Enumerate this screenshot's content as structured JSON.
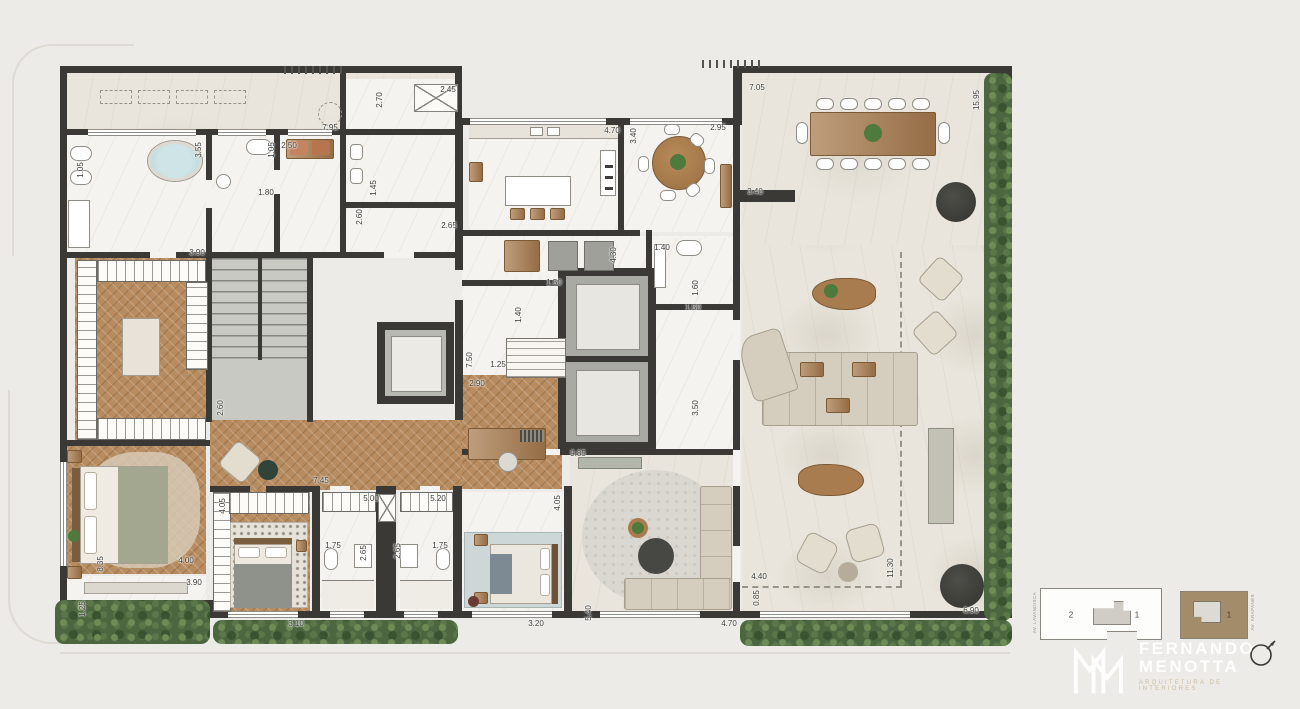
{
  "palette": {
    "bg": "#edebe7",
    "wall": "#3a3936",
    "marble_white": "#f5f3ef",
    "marble_warm": "#e9e5dc",
    "wood": "#b78c60",
    "wood_dark": "#a97c4f",
    "concrete": "#c8c9c3",
    "sofa": "#d5cebe",
    "hedge_green": "#4c6740",
    "keyplan_tan": "#a38c6a"
  },
  "annotations": {
    "dimensions": [
      {
        "t": "1.05",
        "x": 81,
        "y": 170,
        "v": true
      },
      {
        "t": "7.95",
        "x": 330,
        "y": 128,
        "v": false
      },
      {
        "t": "2.70",
        "x": 380,
        "y": 100,
        "v": true
      },
      {
        "t": "2.45",
        "x": 448,
        "y": 90,
        "v": false
      },
      {
        "t": "3.55",
        "x": 199,
        "y": 150,
        "v": true
      },
      {
        "t": "2.50",
        "x": 289,
        "y": 146,
        "v": false
      },
      {
        "t": "1.05",
        "x": 272,
        "y": 150,
        "v": true
      },
      {
        "t": "1.80",
        "x": 266,
        "y": 193,
        "v": false
      },
      {
        "t": "1.45",
        "x": 374,
        "y": 188,
        "v": true
      },
      {
        "t": "2.60",
        "x": 360,
        "y": 217,
        "v": true
      },
      {
        "t": "2.65",
        "x": 449,
        "y": 226,
        "v": false
      },
      {
        "t": "3.90",
        "x": 197,
        "y": 253,
        "v": false
      },
      {
        "t": "4.70",
        "x": 612,
        "y": 131,
        "v": false
      },
      {
        "t": "3.40",
        "x": 634,
        "y": 136,
        "v": true
      },
      {
        "t": "2.95",
        "x": 718,
        "y": 128,
        "v": false
      },
      {
        "t": "7.05",
        "x": 757,
        "y": 88,
        "v": false
      },
      {
        "t": "15.95",
        "x": 977,
        "y": 100,
        "v": true
      },
      {
        "t": "3.40",
        "x": 755,
        "y": 192,
        "v": false
      },
      {
        "t": "1.40",
        "x": 662,
        "y": 248,
        "v": false
      },
      {
        "t": "4.30",
        "x": 614,
        "y": 255,
        "v": true
      },
      {
        "t": "1.50",
        "x": 554,
        "y": 283,
        "v": false
      },
      {
        "t": "1.40",
        "x": 519,
        "y": 315,
        "v": true
      },
      {
        "t": "1.60",
        "x": 696,
        "y": 288,
        "v": true
      },
      {
        "t": "1.50",
        "x": 693,
        "y": 308,
        "v": false
      },
      {
        "t": "7.50",
        "x": 470,
        "y": 360,
        "v": true
      },
      {
        "t": "1.25",
        "x": 498,
        "y": 365,
        "v": false
      },
      {
        "t": "2.90",
        "x": 477,
        "y": 384,
        "v": false
      },
      {
        "t": "3.50",
        "x": 696,
        "y": 408,
        "v": true
      },
      {
        "t": "2.60",
        "x": 221,
        "y": 408,
        "v": true
      },
      {
        "t": "9.85",
        "x": 578,
        "y": 454,
        "v": false
      },
      {
        "t": "7.45",
        "x": 321,
        "y": 481,
        "v": false
      },
      {
        "t": "4.05",
        "x": 223,
        "y": 506,
        "v": true
      },
      {
        "t": "5.00",
        "x": 371,
        "y": 499,
        "v": false
      },
      {
        "t": "5.20",
        "x": 438,
        "y": 499,
        "v": false
      },
      {
        "t": "1.75",
        "x": 333,
        "y": 546,
        "v": false
      },
      {
        "t": "2.65",
        "x": 364,
        "y": 553,
        "v": true
      },
      {
        "t": "2.65",
        "x": 398,
        "y": 551,
        "v": true
      },
      {
        "t": "1.75",
        "x": 440,
        "y": 546,
        "v": false
      },
      {
        "t": "8.35",
        "x": 101,
        "y": 564,
        "v": true
      },
      {
        "t": "4.00",
        "x": 186,
        "y": 561,
        "v": false
      },
      {
        "t": "3.90",
        "x": 194,
        "y": 583,
        "v": false
      },
      {
        "t": "1.25",
        "x": 83,
        "y": 609,
        "v": true
      },
      {
        "t": "3.10",
        "x": 296,
        "y": 624,
        "v": false
      },
      {
        "t": "3.20",
        "x": 536,
        "y": 624,
        "v": false
      },
      {
        "t": "4.05",
        "x": 558,
        "y": 503,
        "v": true
      },
      {
        "t": "5.40",
        "x": 589,
        "y": 613,
        "v": true
      },
      {
        "t": "4.70",
        "x": 729,
        "y": 624,
        "v": false
      },
      {
        "t": "4.40",
        "x": 759,
        "y": 577,
        "v": false
      },
      {
        "t": "0.85",
        "x": 757,
        "y": 598,
        "v": true
      },
      {
        "t": "11.30",
        "x": 891,
        "y": 568,
        "v": true
      },
      {
        "t": "6.90",
        "x": 971,
        "y": 611,
        "v": false
      }
    ]
  },
  "keyplans": {
    "left": {
      "unit_left": "2",
      "unit_right": "1",
      "street": "AV. LAVANDISCA"
    },
    "right": {
      "unit": "1",
      "street": "AV. ARAPANÉS"
    }
  },
  "brand": {
    "name_line1": "FERNANDO",
    "name_line2": "MENOTTA",
    "tagline": "ARQUITETURA DE INTERIORES"
  }
}
